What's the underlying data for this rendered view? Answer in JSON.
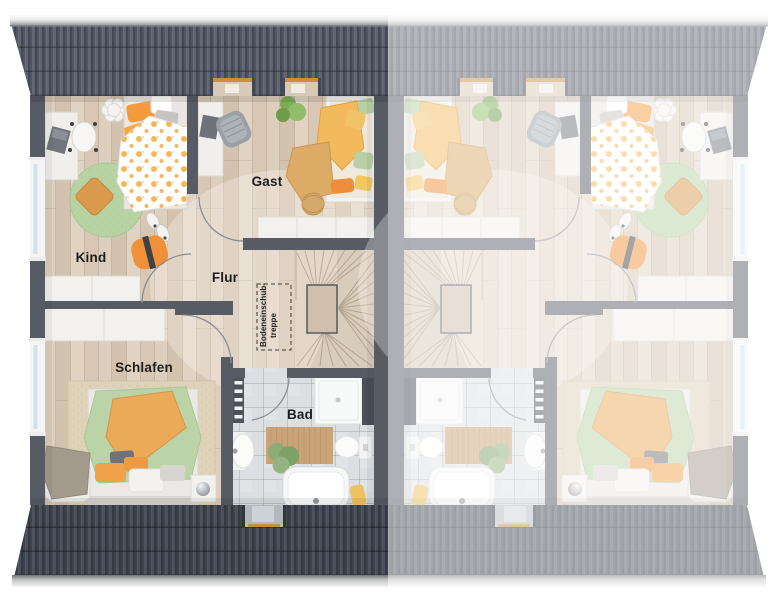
{
  "room_labels": {
    "kind": "Kind",
    "gast": "Gast",
    "flur": "Flur",
    "schlafen": "Schlafen",
    "bad": "Bad",
    "attic_stairs_line1": "Bodeneinschub-",
    "attic_stairs_line2": "treppe"
  },
  "palette": {
    "roof_top": "#50545f",
    "roof_bottom": "#3f434d",
    "wall": "#575b64",
    "wood_floor": "#dacbb8",
    "bath_tile": "#dcdfe2",
    "stair_wood": "#e4d7c6",
    "accent_orange": "#f29a3f",
    "accent_yellow": "#f0bd62",
    "accent_green": "#b7d3a4",
    "window_glass": "#cfe3ed",
    "right_unit_fade": "#ffffff"
  },
  "units": {
    "left": {
      "style": "full color",
      "labels_visible": true
    },
    "right": {
      "style": "mirrored copy, faded",
      "labels_visible": false
    }
  }
}
